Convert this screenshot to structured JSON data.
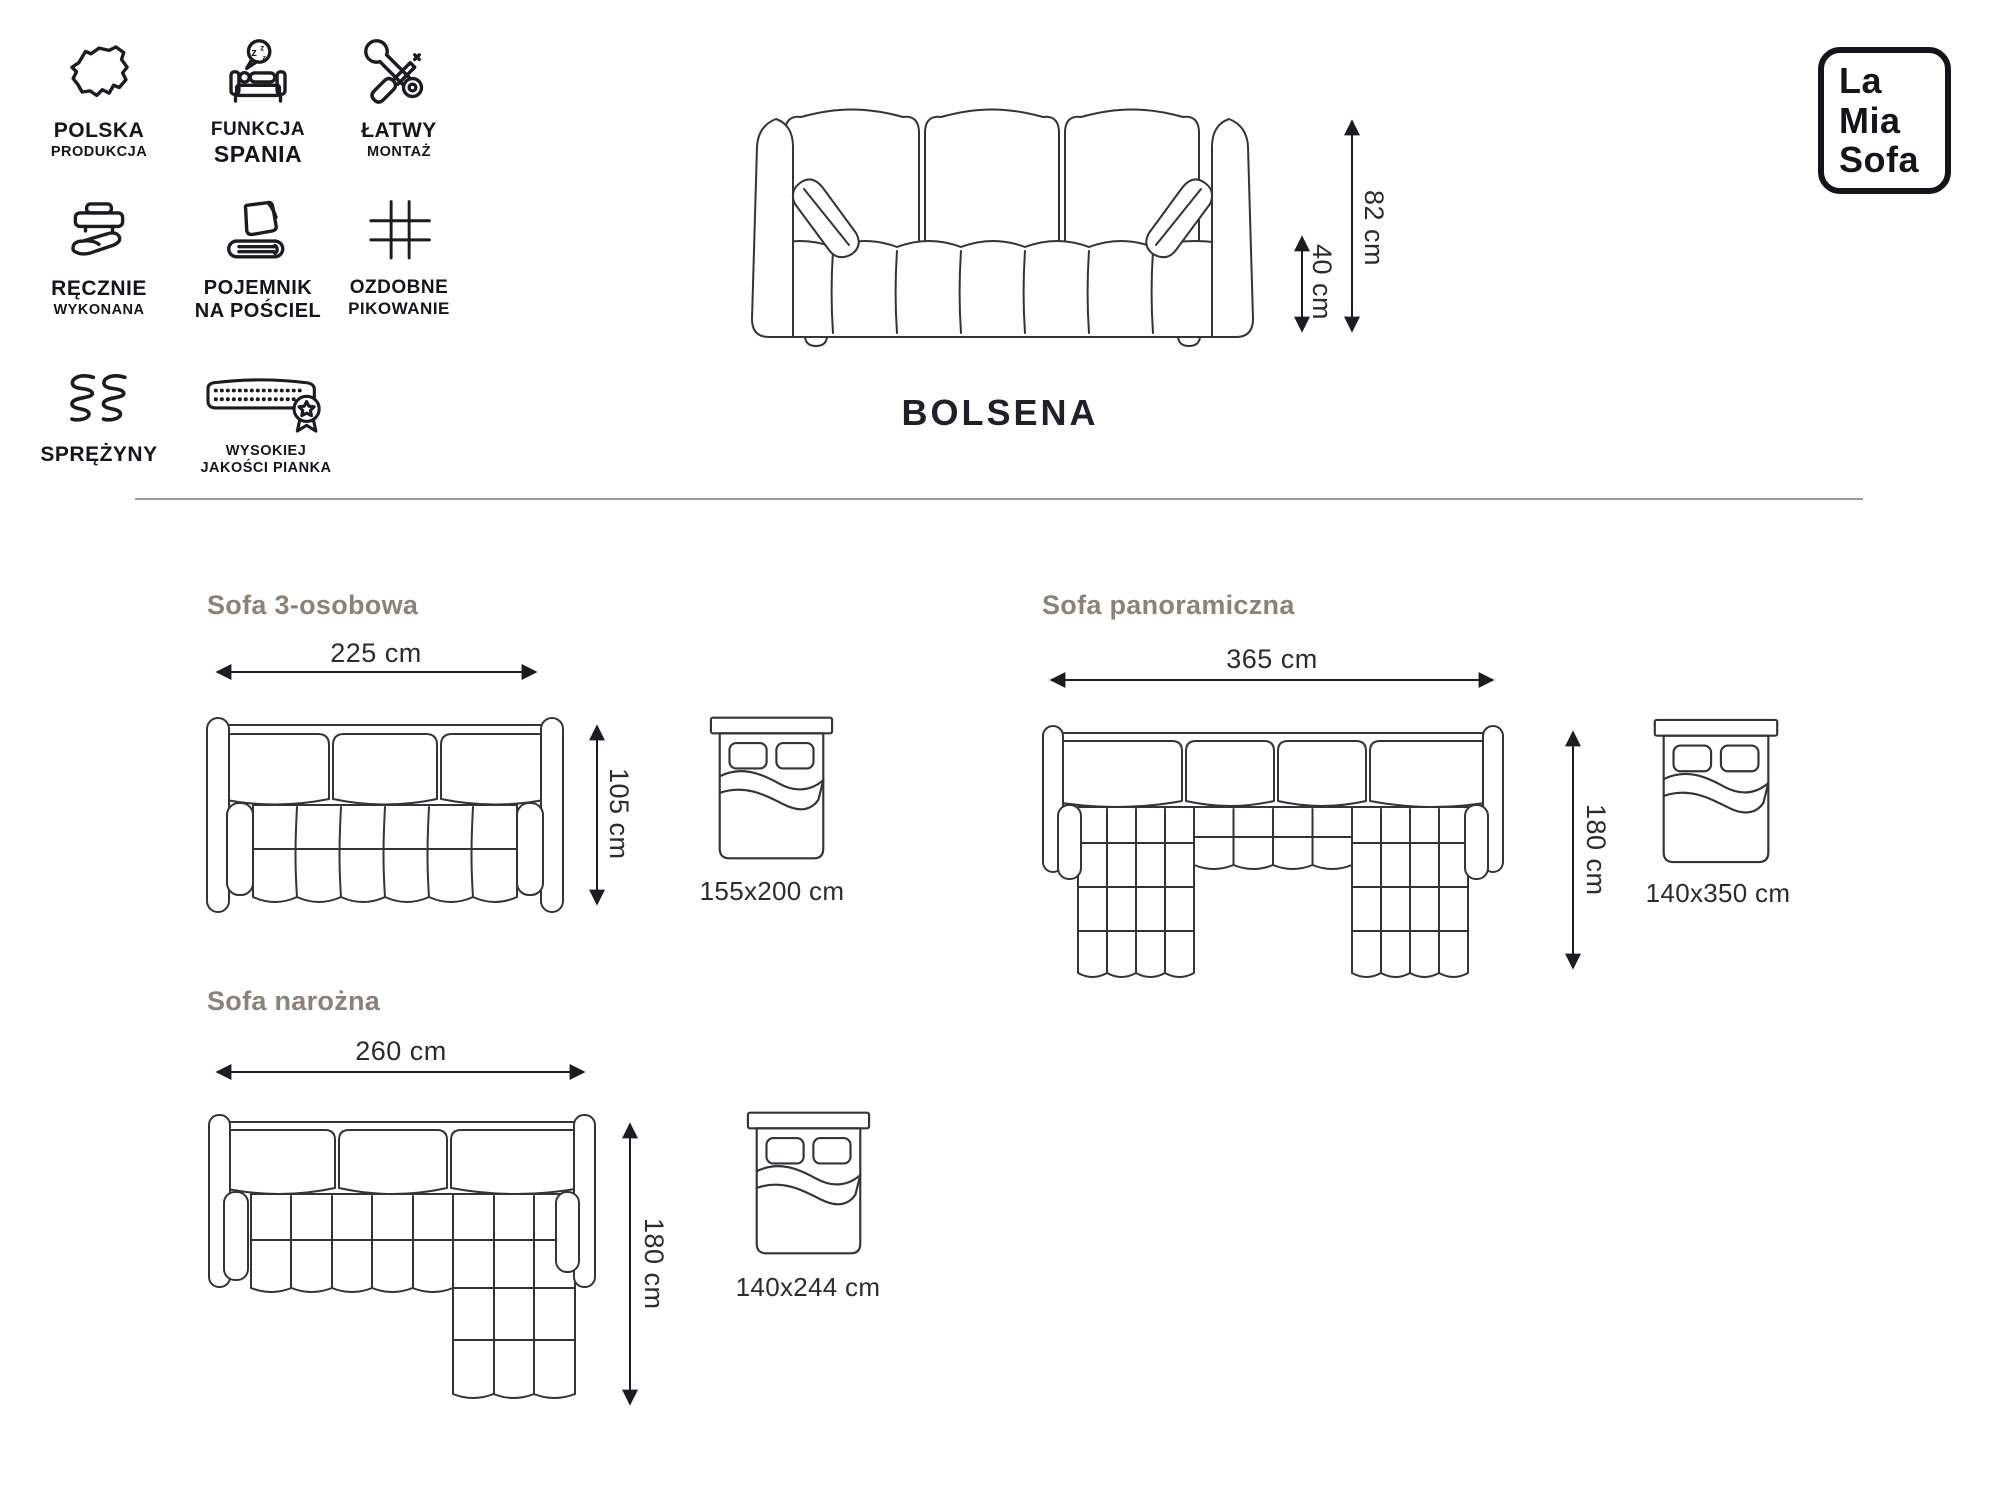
{
  "brand": {
    "lines": [
      "La",
      "Mia",
      "Sofa"
    ]
  },
  "product": {
    "name": "BOLSENA"
  },
  "features": [
    {
      "icon": "poland-map-icon",
      "label": "POLSKA",
      "sublabel": "PRODUKCJA"
    },
    {
      "icon": "sleep-function-icon",
      "label": "FUNKCJA",
      "sublabel": "SPANIA"
    },
    {
      "icon": "easy-assembly-icon",
      "label": "ŁATWY",
      "sublabel": "MONTAŻ"
    },
    {
      "icon": "handmade-icon",
      "label": "RĘCZNIE",
      "sublabel": "WYKONANA"
    },
    {
      "icon": "bedding-storage-icon",
      "label": "POJEMNIK",
      "sublabel": "NA POŚCIEL"
    },
    {
      "icon": "quilting-icon",
      "label": "OZDOBNE",
      "sublabel": "PIKOWANIE"
    },
    {
      "icon": "springs-icon",
      "label": "SPRĘŻYNY",
      "sublabel": ""
    },
    {
      "icon": "foam-quality-icon",
      "label": "WYSOKIEJ",
      "sublabel": "JAKOŚCI PIANKA"
    }
  ],
  "hero": {
    "height": "82 cm",
    "seat_height": "40 cm"
  },
  "variants": {
    "three_seater": {
      "title": "Sofa 3-osobowa",
      "width": "225 cm",
      "depth": "105 cm",
      "bed": "155x200 cm"
    },
    "panoramic": {
      "title": "Sofa panoramiczna",
      "width": "365 cm",
      "depth": "180 cm",
      "bed": "140x350 cm"
    },
    "corner": {
      "title": "Sofa narożna",
      "width": "260 cm",
      "depth": "180 cm",
      "bed": "140x244 cm"
    }
  },
  "colors": {
    "ink": "#15151d",
    "heading": "#8e8178",
    "line_art": "#33333a",
    "divider": "#9c9c9c"
  }
}
